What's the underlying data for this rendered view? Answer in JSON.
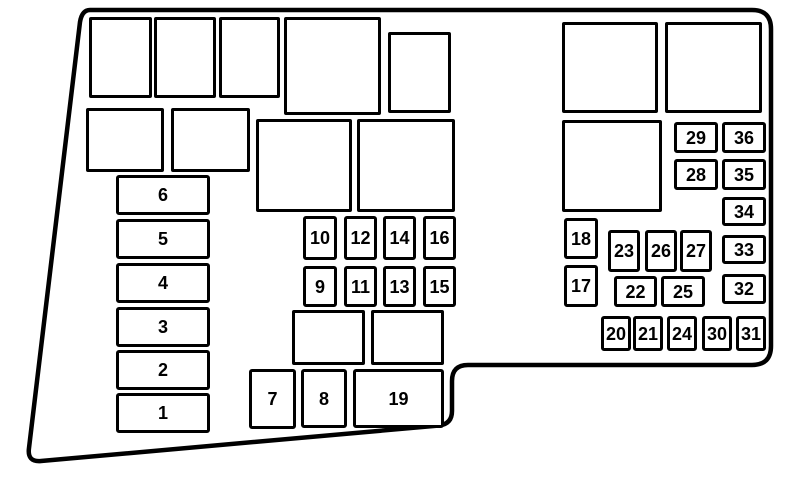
{
  "diagram": {
    "name": "engine-compartment-fuse-box-diagram",
    "background_color": "#ffffff",
    "stroke_color": "#000000"
  },
  "fuses": [
    {
      "id": 1,
      "label": "1"
    },
    {
      "id": 2,
      "label": "2"
    },
    {
      "id": 3,
      "label": "3"
    },
    {
      "id": 4,
      "label": "4"
    },
    {
      "id": 5,
      "label": "5"
    },
    {
      "id": 6,
      "label": "6"
    },
    {
      "id": 7,
      "label": "7"
    },
    {
      "id": 8,
      "label": "8"
    },
    {
      "id": 9,
      "label": "9"
    },
    {
      "id": 10,
      "label": "10"
    },
    {
      "id": 11,
      "label": "11"
    },
    {
      "id": 12,
      "label": "12"
    },
    {
      "id": 13,
      "label": "13"
    },
    {
      "id": 14,
      "label": "14"
    },
    {
      "id": 15,
      "label": "15"
    },
    {
      "id": 16,
      "label": "16"
    },
    {
      "id": 17,
      "label": "17"
    },
    {
      "id": 18,
      "label": "18"
    },
    {
      "id": 19,
      "label": "19"
    },
    {
      "id": 20,
      "label": "20"
    },
    {
      "id": 21,
      "label": "21"
    },
    {
      "id": 22,
      "label": "22"
    },
    {
      "id": 23,
      "label": "23"
    },
    {
      "id": 24,
      "label": "24"
    },
    {
      "id": 25,
      "label": "25"
    },
    {
      "id": 26,
      "label": "26"
    },
    {
      "id": 27,
      "label": "27"
    },
    {
      "id": 28,
      "label": "28"
    },
    {
      "id": 29,
      "label": "29"
    },
    {
      "id": 30,
      "label": "30"
    },
    {
      "id": 31,
      "label": "31"
    },
    {
      "id": 32,
      "label": "32"
    },
    {
      "id": 33,
      "label": "33"
    },
    {
      "id": 34,
      "label": "34"
    },
    {
      "id": 35,
      "label": "35"
    },
    {
      "id": 36,
      "label": "36"
    }
  ]
}
